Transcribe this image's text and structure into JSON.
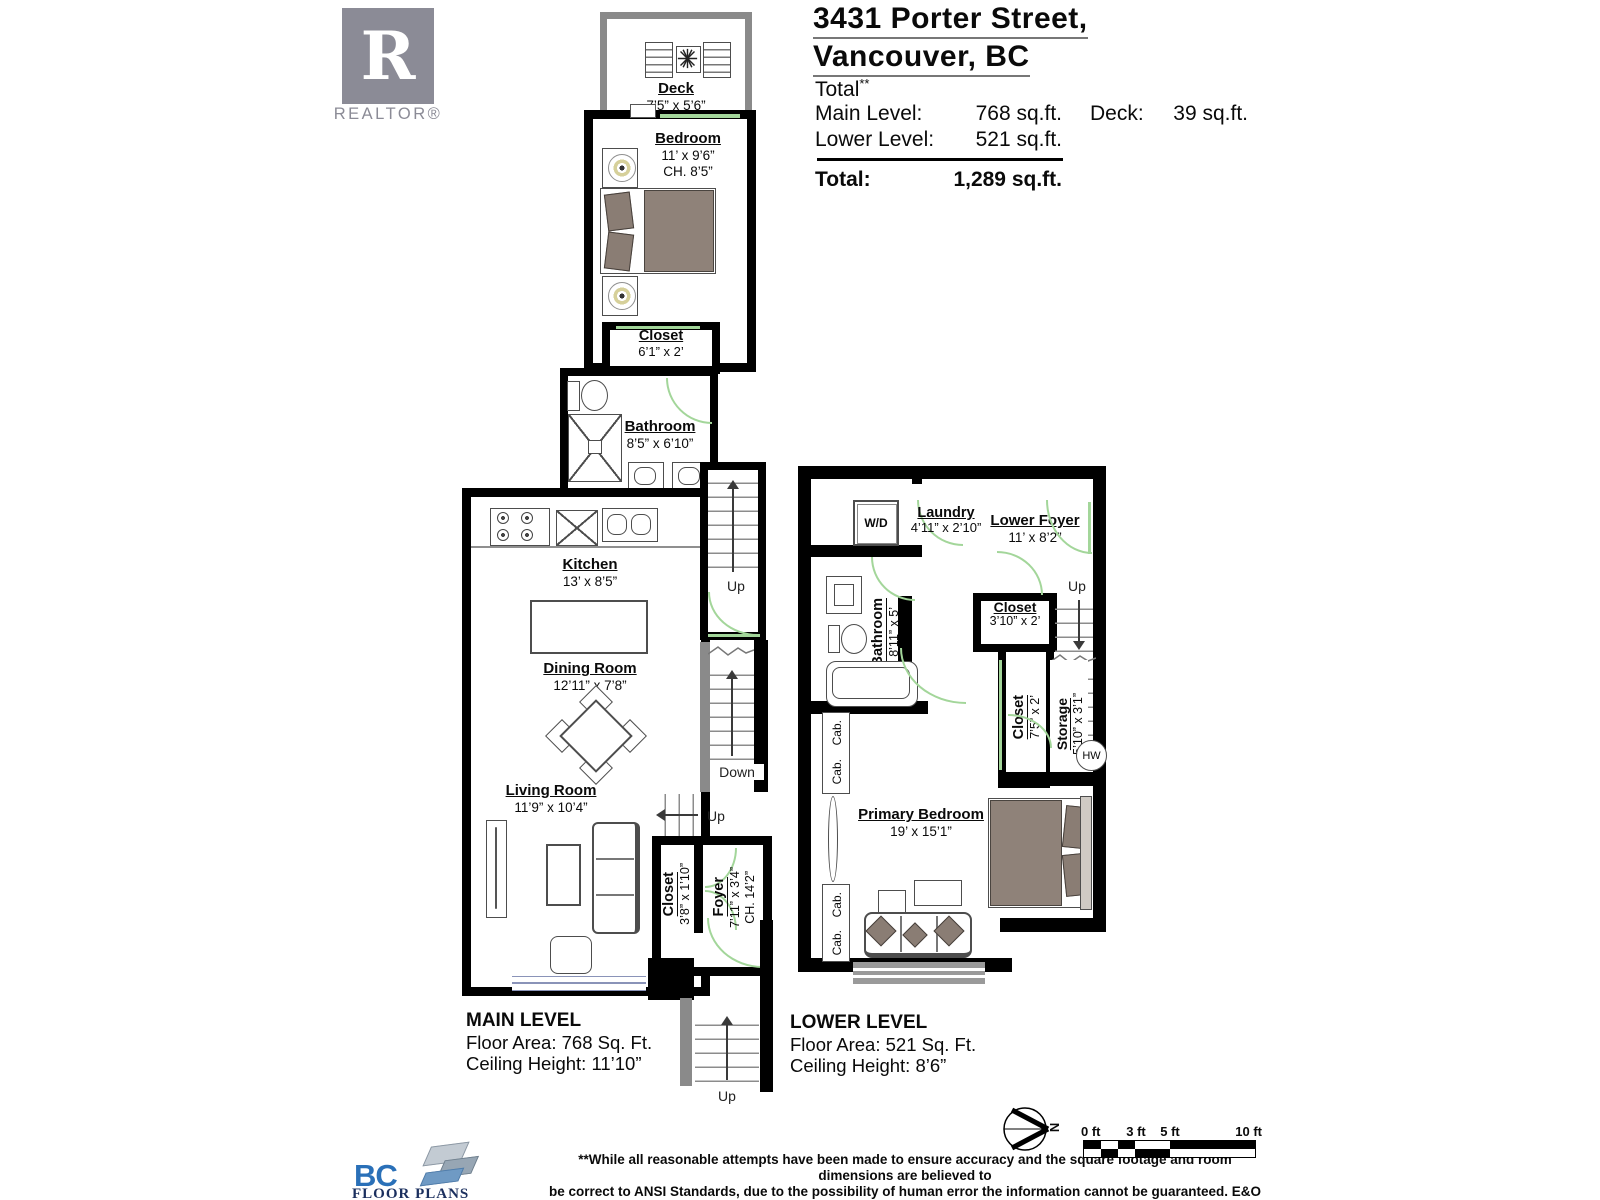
{
  "branding": {
    "realtor_letter": "R",
    "realtor_text": "REALTOR®",
    "bc_text": "BC",
    "bc_subtext": "FLOOR PLANS"
  },
  "header": {
    "address_line1": "3431  Porter Street,",
    "address_line2": "Vancouver, BC",
    "total_word": "Total",
    "total_stars": "**",
    "main_label": "Main Level:",
    "main_value": "768 sq.ft.",
    "deck_label": "Deck:",
    "deck_value": "39 sq.ft.",
    "lower_label": "Lower Level:",
    "lower_value": "521 sq.ft.",
    "total_label": "Total:",
    "total_value": "1,289 sq.ft."
  },
  "main_level": {
    "deck": {
      "name": "Deck",
      "dims": "7’5” x 5’6”"
    },
    "bedroom": {
      "name": "Bedroom",
      "dims": "11’ x 9’6”",
      "ch": "CH. 8’5”"
    },
    "closet": {
      "name": "Closet",
      "dims": "6’1” x 2’"
    },
    "bathroom": {
      "name": "Bathroom",
      "dims": "8’5” x 6’10”"
    },
    "kitchen": {
      "name": "Kitchen",
      "dims": "13’ x 8’5”"
    },
    "dining": {
      "name": "Dining Room",
      "dims": "12’11” x 7’8”"
    },
    "living": {
      "name": "Living Room",
      "dims": "11’9” x 10’4”"
    },
    "entry_closet": {
      "name": "Closet",
      "dims": "3’8” x 1’10”"
    },
    "foyer": {
      "name": "Foyer",
      "dims": "7’11” x 3’4”",
      "ch": "CH. 14’2”"
    },
    "up1": "Up",
    "down": "Down",
    "up2": "Up",
    "up3": "Up",
    "footer": {
      "title": "MAIN LEVEL",
      "area": "Floor Area: 768 Sq. Ft.",
      "ceiling": "Ceiling Height: 11’10”"
    }
  },
  "lower_level": {
    "wd": "W/D",
    "laundry": {
      "name": "Laundry",
      "dims": "4’11” x 2’10”"
    },
    "lower_foyer": {
      "name": "Lower Foyer",
      "dims": "11’ x 8’2”"
    },
    "bathroom": {
      "name": "Bathroom",
      "dims": "8’11” x 5’"
    },
    "closet1": {
      "name": "Closet",
      "dims": "3’10” x 2’"
    },
    "closet2": {
      "name": "Closet",
      "dims": "7’5” x 2’"
    },
    "storage": {
      "name": "Storage",
      "dims": "5’10” x 3’1”"
    },
    "primary": {
      "name": "Primary Bedroom",
      "dims": "19’ x 15’1”"
    },
    "hw": "HW",
    "up": "Up",
    "cab": "Cab.",
    "footer": {
      "title": "LOWER LEVEL",
      "area": "Floor Area: 521 Sq. Ft.",
      "ceiling": "Ceiling Height: 8’6”"
    }
  },
  "bottom": {
    "disclaimer1": "**While all reasonable attempts have been made to ensure accuracy and the square footage and room dimensions are believed to",
    "disclaimer2": "be correct to ANSI Standards, due to the possibility of human error the information cannot be guaranteed. E&O Insured for $1,000,000",
    "disclaimer3": "** May Include Unfinished areas",
    "compass_n": "N",
    "scale_labels": [
      "0 ft",
      "3 ft",
      "5 ft",
      "10 ft"
    ]
  },
  "colors": {
    "wall": "#000000",
    "light_wall": "#8a8a8a",
    "door_swing": "#a3d69a",
    "furniture_taupe": "#8f8279",
    "realtor_gray": "#8b8b96",
    "bc_blue": "#2a70b8",
    "bc_navy": "#1b2f5e"
  }
}
